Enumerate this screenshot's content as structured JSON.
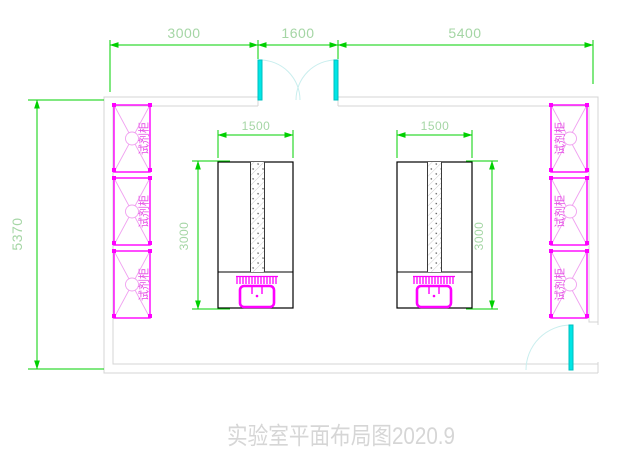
{
  "title": "实验室平面布局图2020.9",
  "dimensions": {
    "top": [
      "3000",
      "1600",
      "5400"
    ],
    "room_height": "5370"
  },
  "benches": [
    {
      "width": "1500",
      "height": "3000"
    },
    {
      "width": "1500",
      "height": "3000"
    }
  ],
  "cabinets": {
    "label": "试剂柜",
    "count_left": 3,
    "count_right": 3
  },
  "colors": {
    "dimension_green": "#00d000",
    "dim_text_green": "#a5d6a5",
    "magenta": "#ff00ff",
    "magenta_light": "#f0a0f0",
    "magenta_text": "#e54fe5",
    "cyan_door": "#00e6e6",
    "cyan_door_stroke": "#00bfbf",
    "cyan_arc": "#c9eeee",
    "wall_gray": "#d4d4d4",
    "title_gray": "#d6d6d6"
  }
}
